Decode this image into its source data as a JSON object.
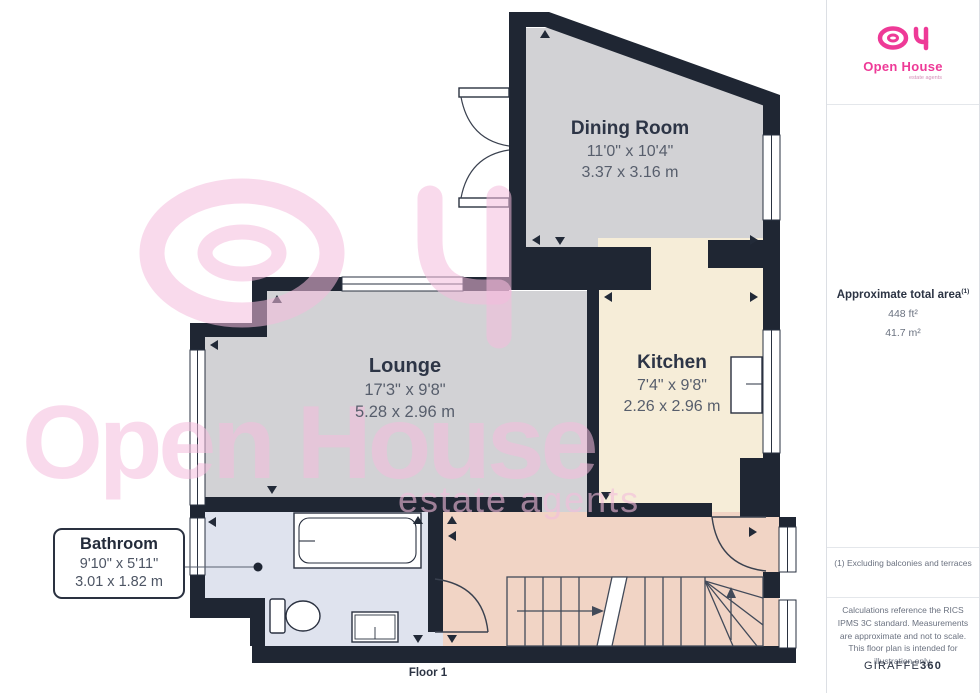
{
  "rooms": [
    {
      "name": "Dining Room",
      "imperial": "11'0\" x 10'4\"",
      "metric": "3.37 x 3.16 m"
    },
    {
      "name": "Lounge",
      "imperial": "17'3\" x 9'8\"",
      "metric": "5.28 x 2.96 m"
    },
    {
      "name": "Kitchen",
      "imperial": "7'4\" x 9'8\"",
      "metric": "2.26 x 2.96 m"
    },
    {
      "name": "Bathroom",
      "imperial": "9'10\" x 5'11\"",
      "metric": "3.01 x 1.82 m"
    }
  ],
  "floor_label": "Floor 1",
  "watermark": {
    "word1": "Open House",
    "word2": "estate agents"
  },
  "sidebar": {
    "logo": {
      "brand": "Open House",
      "tagline": "estate agents"
    },
    "area_title": "Approximate total area",
    "area_superscript": "(1)",
    "area_ft": "448 ft²",
    "area_m": "41.7 m²",
    "note": "(1) Excluding balconies and terraces",
    "disclaimer": "Calculations reference the RICS IPMS 3C standard. Measurements are approximate and not to scale. This floor plan is intended for illustration only.",
    "brand_footer_1": "GIRAFFE",
    "brand_footer_2": "360"
  },
  "colors": {
    "wall": "#1f2633",
    "floor_gray": "#d2d2d5",
    "floor_cream": "#f6edd8",
    "floor_salmon": "#f1d4c5",
    "floor_blue": "#dfe3ee",
    "accent_pink": "#ee3a97",
    "watermark_pink": "#f4bcdc"
  }
}
